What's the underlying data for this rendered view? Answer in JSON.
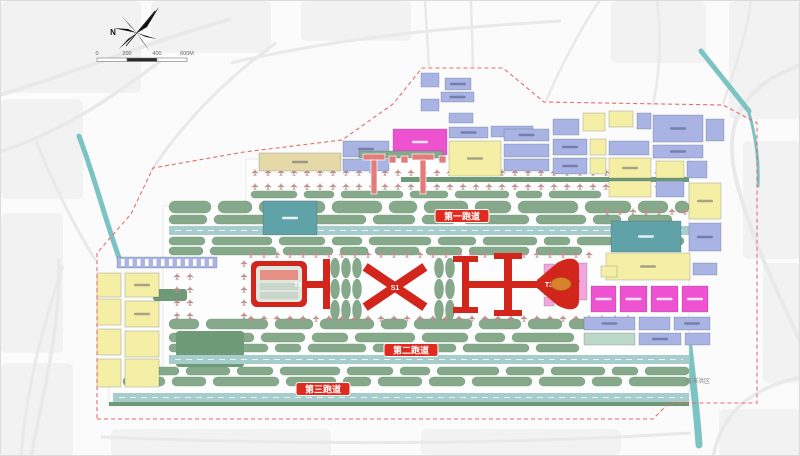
{
  "map": {
    "title": "airport-master-plan",
    "compass_north": "N",
    "scale_ticks": [
      "0",
      "200",
      "400",
      "600M"
    ],
    "runway_labels": [
      "第一跑道",
      "第二跑道",
      "第三跑道"
    ],
    "terminal_labels": {
      "t4": "T4",
      "s1": "S1",
      "t3": "T3"
    },
    "area_labels": {
      "flood": "蓄滞洪区"
    }
  },
  "palette": {
    "terminal_red": "#d2251c",
    "badge_red": "#e02b20",
    "pier_pink": "#e37b7b",
    "island_green": "#85a98a",
    "island_green_dark": "#6f9a78",
    "runway_teal": "#a6cccb",
    "water_teal": "#7cc4c4",
    "block_yellow": "#f5efa5",
    "block_blue": "#a9b4e4",
    "block_magenta": "#ee52d0",
    "block_pink": "#f2a6dc",
    "block_tan": "#e5d9a8",
    "hangar_teal": "#5fa3a8",
    "hub_orange": "#d9822e",
    "road_gray": "#e9e9e9",
    "urban_gray": "#f2f2f2",
    "boundary_red": "#e86a6a",
    "stand_red": "#bd8f8f",
    "apron_white": "#fdfdfd"
  }
}
